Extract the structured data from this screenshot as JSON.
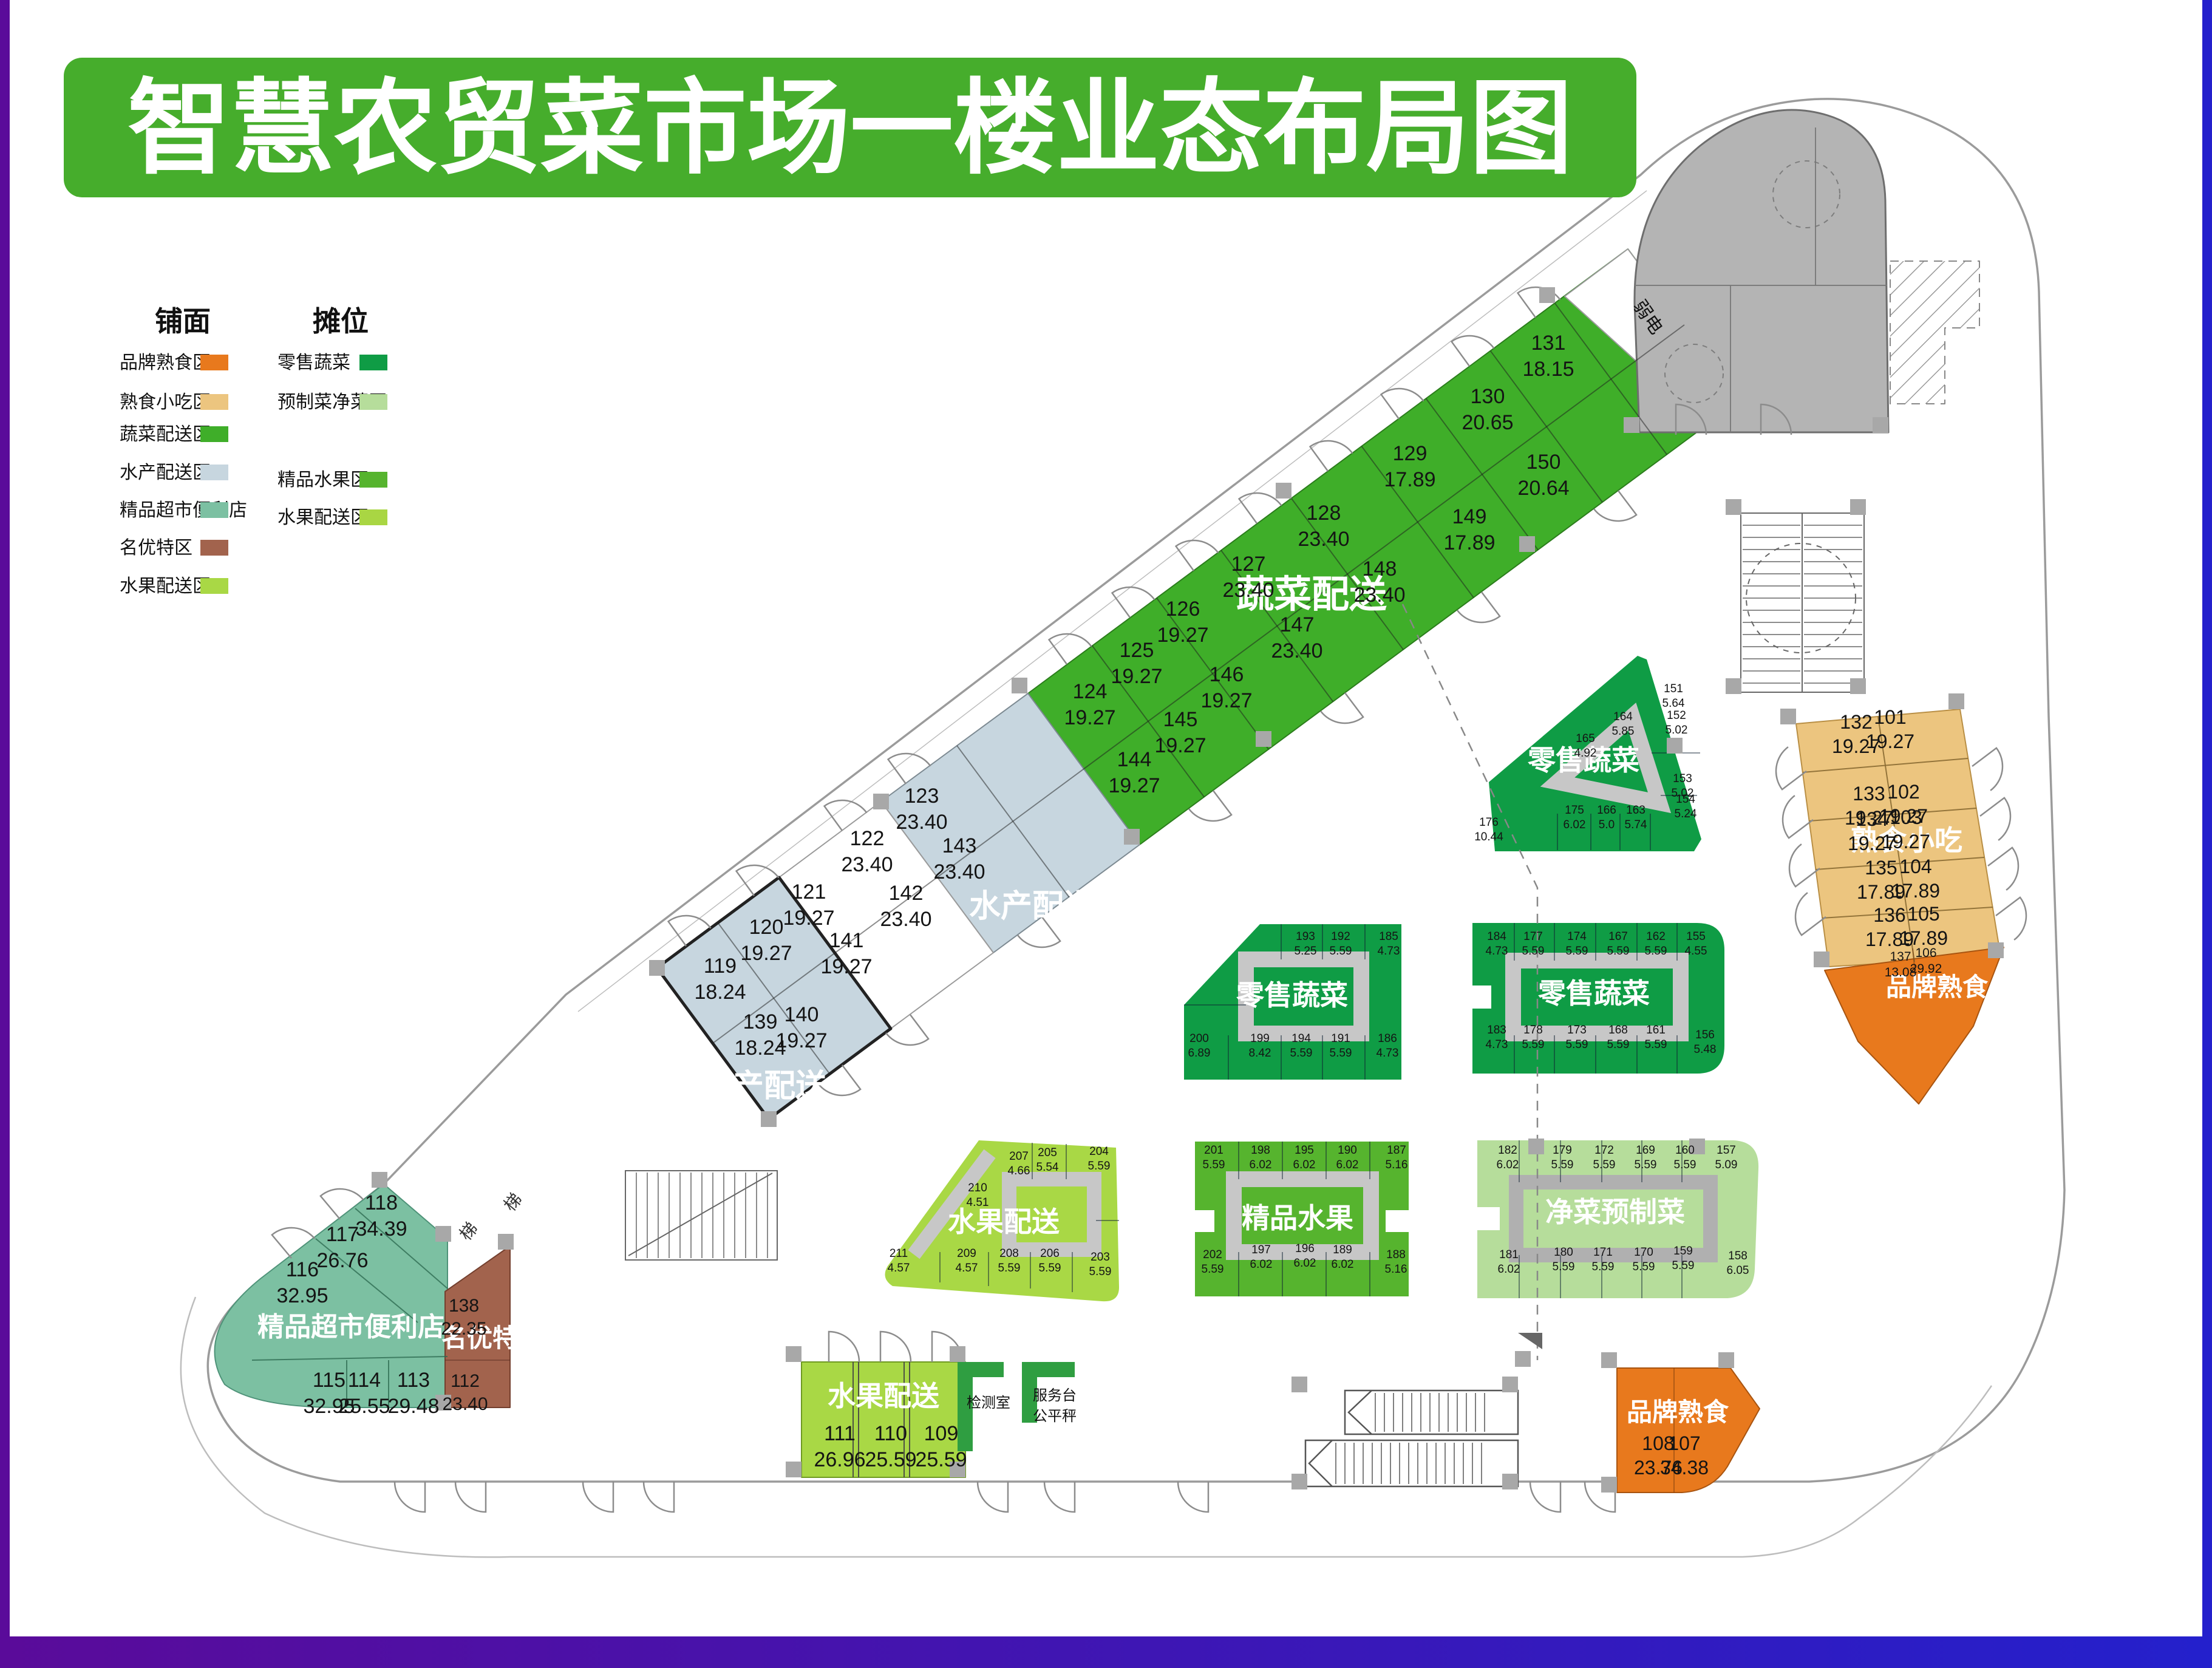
{
  "title": "智慧农贸菜市场一楼业态布局图",
  "legend": {
    "shop_heading": "铺面",
    "stall_heading": "摊位",
    "shop_items": [
      {
        "label": "品牌熟食区",
        "color": "#e8791d"
      },
      {
        "label": "熟食小吃区",
        "color": "#ecc57f"
      },
      {
        "label": "蔬菜配送区",
        "color": "#3fae29"
      },
      {
        "label": "水产配送区",
        "color": "#c7d6df"
      },
      {
        "label": "精品超市便利店",
        "color": "#7cc0a2"
      },
      {
        "label": "名优特区",
        "color": "#a2634d"
      },
      {
        "label": "水果配送区",
        "color": "#a9d845"
      }
    ],
    "stall_items": [
      {
        "label": "零售蔬菜",
        "color": "#0f9c45"
      },
      {
        "label": "预制菜净菜区",
        "color": "#b6dd9b"
      },
      {
        "label": "精品水果区",
        "color": "#56b42e"
      },
      {
        "label": "水果配送区",
        "color": "#a9d643"
      }
    ]
  },
  "plan": {
    "zone_labels": [
      {
        "id": "veg_delivery",
        "text": "蔬菜配送"
      },
      {
        "id": "aqua_upper",
        "text": "水产配送"
      },
      {
        "id": "aqua_lower",
        "text": "水产配送"
      },
      {
        "id": "supermarket",
        "text": "精品超市便利店"
      },
      {
        "id": "mingyoute",
        "text": "名优特"
      },
      {
        "id": "fruit_shop",
        "text": "水果配送"
      },
      {
        "id": "retail_top",
        "text": "零售蔬菜"
      },
      {
        "id": "retail_left",
        "text": "零售蔬菜"
      },
      {
        "id": "retail_right",
        "text": "零售蔬菜"
      },
      {
        "id": "fruit_island",
        "text": "水果配送"
      },
      {
        "id": "premium_fruit",
        "text": "精品水果"
      },
      {
        "id": "clean_veg",
        "text": "净菜预制菜"
      },
      {
        "id": "deli_snack",
        "text": "熟食小吃"
      },
      {
        "id": "brand_right",
        "text": "品牌熟食"
      },
      {
        "id": "brand_bottom",
        "text": "品牌熟食"
      },
      {
        "id": "weak_power",
        "text": "弱电"
      },
      {
        "id": "test_room",
        "text": "检测室"
      },
      {
        "id": "service_desk",
        "text": "服务台"
      },
      {
        "id": "fair_scale",
        "text": "公平秤"
      },
      {
        "id": "stair1",
        "text": "梯"
      },
      {
        "id": "stair2",
        "text": "梯"
      }
    ],
    "stalls": [
      {
        "no": "124",
        "area": "19.27",
        "zone": "蔬菜配送"
      },
      {
        "no": "125",
        "area": "19.27",
        "zone": "蔬菜配送"
      },
      {
        "no": "126",
        "area": "19.27",
        "zone": "蔬菜配送"
      },
      {
        "no": "127",
        "area": "23.40",
        "zone": "蔬菜配送"
      },
      {
        "no": "128",
        "area": "23.40",
        "zone": "蔬菜配送"
      },
      {
        "no": "129",
        "area": "17.89",
        "zone": "蔬菜配送"
      },
      {
        "no": "130",
        "area": "20.65",
        "zone": "蔬菜配送"
      },
      {
        "no": "131",
        "area": "18.15",
        "zone": "蔬菜配送"
      },
      {
        "no": "144",
        "area": "19.27",
        "zone": "蔬菜配送"
      },
      {
        "no": "145",
        "area": "19.27",
        "zone": "蔬菜配送"
      },
      {
        "no": "146",
        "area": "19.27",
        "zone": "蔬菜配送"
      },
      {
        "no": "147",
        "area": "23.40",
        "zone": "蔬菜配送"
      },
      {
        "no": "148",
        "area": "23.40",
        "zone": "蔬菜配送"
      },
      {
        "no": "149",
        "area": "17.89",
        "zone": "蔬菜配送"
      },
      {
        "no": "150",
        "area": "20.64",
        "zone": "蔬菜配送"
      },
      {
        "no": "119",
        "area": "18.24",
        "zone": "水产配送"
      },
      {
        "no": "120",
        "area": "19.27",
        "zone": "水产配送"
      },
      {
        "no": "121",
        "area": "19.27",
        "zone": "水产配送"
      },
      {
        "no": "122",
        "area": "23.40",
        "zone": "水产配送"
      },
      {
        "no": "123",
        "area": "23.40",
        "zone": "水产配送"
      },
      {
        "no": "139",
        "area": "18.24",
        "zone": "水产配送"
      },
      {
        "no": "140",
        "area": "19.27",
        "zone": "水产配送"
      },
      {
        "no": "141",
        "area": "19.27",
        "zone": "水产配送"
      },
      {
        "no": "142",
        "area": "23.40",
        "zone": "水产配送"
      },
      {
        "no": "143",
        "area": "23.40",
        "zone": "水产配送"
      },
      {
        "no": "113",
        "area": "29.48",
        "zone": "精品超市便利店"
      },
      {
        "no": "114",
        "area": "25.55",
        "zone": "精品超市便利店"
      },
      {
        "no": "115",
        "area": "32.95",
        "zone": "精品超市便利店"
      },
      {
        "no": "116",
        "area": "32.95",
        "zone": "精品超市便利店"
      },
      {
        "no": "117",
        "area": "26.76",
        "zone": "精品超市便利店"
      },
      {
        "no": "118",
        "area": "34.39",
        "zone": "精品超市便利店"
      },
      {
        "no": "112",
        "area": "23.40",
        "zone": "名优特"
      },
      {
        "no": "138",
        "area": "22.35",
        "zone": "名优特"
      },
      {
        "no": "109",
        "area": "25.59",
        "zone": "水果配送"
      },
      {
        "no": "110",
        "area": "25.59",
        "zone": "水果配送"
      },
      {
        "no": "111",
        "area": "26.96",
        "zone": "水果配送"
      },
      {
        "no": "107",
        "area": "34.38",
        "zone": "品牌熟食"
      },
      {
        "no": "108",
        "area": "23.76",
        "zone": "品牌熟食"
      },
      {
        "no": "106",
        "area": "29.92",
        "zone": "品牌熟食"
      },
      {
        "no": "137",
        "area": "13.08",
        "zone": "品牌熟食"
      },
      {
        "no": "101",
        "area": "19.27",
        "zone": "熟食小吃"
      },
      {
        "no": "102",
        "area": "19.27",
        "zone": "熟食小吃"
      },
      {
        "no": "103",
        "area": "19.27",
        "zone": "熟食小吃"
      },
      {
        "no": "104",
        "area": "17.89",
        "zone": "熟食小吃"
      },
      {
        "no": "105",
        "area": "17.89",
        "zone": "熟食小吃"
      },
      {
        "no": "132",
        "area": "19.27",
        "zone": "熟食小吃"
      },
      {
        "no": "133",
        "area": "19.27",
        "zone": "熟食小吃"
      },
      {
        "no": "134",
        "area": "19.27",
        "zone": "熟食小吃"
      },
      {
        "no": "135",
        "area": "17.89",
        "zone": "熟食小吃"
      },
      {
        "no": "136",
        "area": "17.89",
        "zone": "熟食小吃"
      },
      {
        "no": "151",
        "area": "5.64",
        "zone": "零售蔬菜"
      },
      {
        "no": "152",
        "area": "5.02",
        "zone": "零售蔬菜"
      },
      {
        "no": "153",
        "area": "5.02",
        "zone": "零售蔬菜"
      },
      {
        "no": "154",
        "area": "5.24",
        "zone": "零售蔬菜"
      },
      {
        "no": "163",
        "area": "5.74",
        "zone": "零售蔬菜"
      },
      {
        "no": "164",
        "area": "5.85",
        "zone": "零售蔬菜"
      },
      {
        "no": "165",
        "area": "4.92",
        "zone": "零售蔬菜"
      },
      {
        "no": "166",
        "area": "5.0",
        "zone": "零售蔬菜"
      },
      {
        "no": "175",
        "area": "6.02",
        "zone": "零售蔬菜"
      },
      {
        "no": "176",
        "area": "10.44",
        "zone": "零售蔬菜"
      },
      {
        "no": "185",
        "area": "4.73",
        "zone": "零售蔬菜"
      },
      {
        "no": "186",
        "area": "4.73",
        "zone": "零售蔬菜"
      },
      {
        "no": "191",
        "area": "5.59",
        "zone": "零售蔬菜"
      },
      {
        "no": "192",
        "area": "5.59",
        "zone": "零售蔬菜"
      },
      {
        "no": "193",
        "area": "5.25",
        "zone": "零售蔬菜"
      },
      {
        "no": "194",
        "area": "5.59",
        "zone": "零售蔬菜"
      },
      {
        "no": "199",
        "area": "8.42",
        "zone": "零售蔬菜"
      },
      {
        "no": "200",
        "area": "6.89",
        "zone": "零售蔬菜"
      },
      {
        "no": "155",
        "area": "4.55",
        "zone": "零售蔬菜"
      },
      {
        "no": "156",
        "area": "5.48",
        "zone": "零售蔬菜"
      },
      {
        "no": "161",
        "area": "5.59",
        "zone": "零售蔬菜"
      },
      {
        "no": "162",
        "area": "5.59",
        "zone": "零售蔬菜"
      },
      {
        "no": "167",
        "area": "5.59",
        "zone": "零售蔬菜"
      },
      {
        "no": "168",
        "area": "5.59",
        "zone": "零售蔬菜"
      },
      {
        "no": "173",
        "area": "5.59",
        "zone": "零售蔬菜"
      },
      {
        "no": "174",
        "area": "5.59",
        "zone": "零售蔬菜"
      },
      {
        "no": "177",
        "area": "5.59",
        "zone": "零售蔬菜"
      },
      {
        "no": "178",
        "area": "5.59",
        "zone": "零售蔬菜"
      },
      {
        "no": "183",
        "area": "4.73",
        "zone": "零售蔬菜"
      },
      {
        "no": "184",
        "area": "4.73",
        "zone": "零售蔬菜"
      },
      {
        "no": "203",
        "area": "5.59",
        "zone": "水果配送"
      },
      {
        "no": "204",
        "area": "5.59",
        "zone": "水果配送"
      },
      {
        "no": "205",
        "area": "5.54",
        "zone": "水果配送"
      },
      {
        "no": "206",
        "area": "5.59",
        "zone": "水果配送"
      },
      {
        "no": "207",
        "area": "4.66",
        "zone": "水果配送"
      },
      {
        "no": "208",
        "area": "5.59",
        "zone": "水果配送"
      },
      {
        "no": "209",
        "area": "4.57",
        "zone": "水果配送"
      },
      {
        "no": "210",
        "area": "4.51",
        "zone": "水果配送"
      },
      {
        "no": "211",
        "area": "4.57",
        "zone": "水果配送"
      },
      {
        "no": "187",
        "area": "5.16",
        "zone": "精品水果"
      },
      {
        "no": "188",
        "area": "5.16",
        "zone": "精品水果"
      },
      {
        "no": "189",
        "area": "6.02",
        "zone": "精品水果"
      },
      {
        "no": "190",
        "area": "6.02",
        "zone": "精品水果"
      },
      {
        "no": "195",
        "area": "6.02",
        "zone": "精品水果"
      },
      {
        "no": "196",
        "area": "6.02",
        "zone": "精品水果"
      },
      {
        "no": "197",
        "area": "6.02",
        "zone": "精品水果"
      },
      {
        "no": "198",
        "area": "6.02",
        "zone": "精品水果"
      },
      {
        "no": "201",
        "area": "5.59",
        "zone": "精品水果"
      },
      {
        "no": "202",
        "area": "5.59",
        "zone": "精品水果"
      },
      {
        "no": "157",
        "area": "5.09",
        "zone": "净菜预制菜"
      },
      {
        "no": "158",
        "area": "6.05",
        "zone": "净菜预制菜"
      },
      {
        "no": "159",
        "area": "5.59",
        "zone": "净菜预制菜"
      },
      {
        "no": "160",
        "area": "5.59",
        "zone": "净菜预制菜"
      },
      {
        "no": "169",
        "area": "5.59",
        "zone": "净菜预制菜"
      },
      {
        "no": "170",
        "area": "5.59",
        "zone": "净菜预制菜"
      },
      {
        "no": "171",
        "area": "5.59",
        "zone": "净菜预制菜"
      },
      {
        "no": "172",
        "area": "5.59",
        "zone": "净菜预制菜"
      },
      {
        "no": "179",
        "area": "5.59",
        "zone": "净菜预制菜"
      },
      {
        "no": "180",
        "area": "5.59",
        "zone": "净菜预制菜"
      },
      {
        "no": "181",
        "area": "6.02",
        "zone": "净菜预制菜"
      },
      {
        "no": "182",
        "area": "6.02",
        "zone": "净菜预制菜"
      }
    ]
  }
}
